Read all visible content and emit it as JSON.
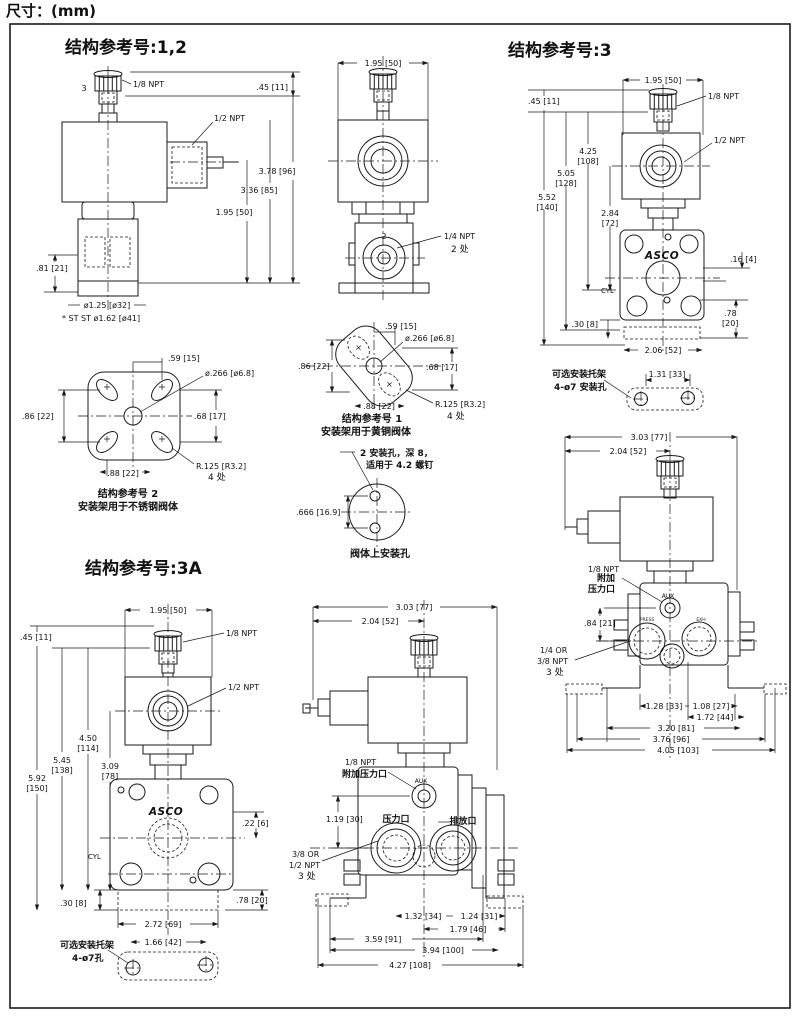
{
  "page": {
    "size_label": "尺寸：(mm)"
  },
  "colors": {
    "ink": "#1a1a1a",
    "paper": "#ffffff"
  },
  "sections": {
    "ref12": {
      "title": "结构参考号:1,2"
    },
    "ref3": {
      "title": "结构参考号:3"
    },
    "ref3a": {
      "title": "结构参考号:3A"
    }
  },
  "valve12_side": {
    "port_num": "3",
    "npt_18": "1/8 NPT",
    "npt_12": "1/2 NPT",
    "dim_top": ".45 [11]",
    "dim_total": "3.78 [96]",
    "dim_mid": "3.36 [85]",
    "dim_coil": "1.95 [50]",
    "dim_body": ".81 [21]",
    "dim_dia": "ø1.25 [ø32]",
    "note": "* ST ST ø1.62 [ø41]"
  },
  "valve12_front": {
    "dim_width": "1.95 [50]",
    "port_num": "2",
    "npt_14": "1/4 NPT",
    "places": "2 处"
  },
  "valve3_front": {
    "dim_width": "1.95 [50]",
    "npt_18": "1/8 NPT",
    "npt_12": "1/2 NPT",
    "dim_top": ".45 [11]",
    "h1a": "4.25",
    "h1b": "[108]",
    "h2a": "5.05",
    "h2b": "[128]",
    "h3a": "5.52",
    "h3b": "[140]",
    "h4a": "2.84",
    "h4b": "[72]",
    "logo": "ASCO",
    "dim_off": ".16 [4]",
    "cyl": "CYL",
    "dim_base": ".30 [8]",
    "dim_lug_a": ".78",
    "dim_lug_b": "[20]",
    "dim_body_w": "2.06 [52]"
  },
  "bracket3_optional": {
    "caption1": "可选安装托架",
    "caption2": "4-ø7 安装孔",
    "dim_holes": "1.31 [33]"
  },
  "plate2": {
    "dim_top": ".59 [15]",
    "dim_hole": "ø.266 [ø6.8]",
    "dim_left": ".86 [22]",
    "dim_right": ".68 [17]",
    "dim_bottom": ".88 [22]",
    "dim_radius": "R.125 [R3.2]",
    "radius_places": "4 处",
    "caption1": "结构参考号 2",
    "caption2": "安装架用于不锈钢阀体"
  },
  "plate1": {
    "dim_top": ".59 [15]",
    "dim_hole": "ø.266 [ø6.8]",
    "dim_left": ".86 [22]",
    "dim_right": ".68 [17]",
    "dim_bottom": ".88 [22]",
    "dim_radius": "R.125 [R3.2]",
    "radius_places": "4 处",
    "caption1": "结构参考号 1",
    "caption2": "安装架用于黄铜阀体"
  },
  "body_holes": {
    "note1": "2 安装孔，深 8，",
    "note2": "适用于 4.2 螺钉",
    "dim_span": ".666 [16.9]",
    "caption": "阀体上安装孔"
  },
  "valve3_side": {
    "dim_total": "3.03 [77]",
    "dim_coil": "2.04 [52]",
    "npt_l1": "1/8 NPT",
    "npt_l2": "附加",
    "npt_l3": "压力口",
    "aux": "AUX",
    "press": "PRESS",
    "exh": "EXH",
    "dim_port": ".84 [21]",
    "port_l1": "1/4 OR",
    "port_l2": "3/8 NPT",
    "port_l3": "3 处",
    "d1": "1.28 [33]",
    "d2": "1.08 [27]",
    "d3": "1.72 [44]",
    "d4": "3.20 [81]",
    "d5": "3.76 [96]",
    "d6": "4.05 [103]"
  },
  "valve3a_front": {
    "dim_width": "1.95 [50]",
    "npt_18": "1/8 NPT",
    "npt_12": "1/2 NPT",
    "dim_top": ".45 [11]",
    "h1a": "4.50",
    "h1b": "[114]",
    "h2a": "5.45",
    "h2b": "[138]",
    "h3a": "5.92",
    "h3b": "[150]",
    "h4a": "3.09",
    "h4b": "[78]",
    "logo": "ASCO",
    "cyl": "CYL",
    "dim_off": ".22 [6]",
    "dim_lug": ".78 [20]",
    "dim_base": ".30 [8]",
    "dim_body_w": "2.72 [69]",
    "bracket_caption1": "可选安装托架",
    "bracket_caption2": "4-ø7孔",
    "bracket_dim": "1.66 [42]"
  },
  "valve3a_side": {
    "dim_total": "3.03 [77]",
    "dim_coil": "2.04 [52]",
    "npt_l1": "1/8 NPT",
    "npt_l2": "附加压力口",
    "aux": "AUX",
    "dim_aux": "1.19 [30]",
    "press_label": "压力口",
    "exh_label": "排放口",
    "port_l1": "3/8 OR",
    "port_l2": "1/2 NPT",
    "port_l3": "3 处",
    "d1": "1.32 [34]",
    "d2": "1.24 [31]",
    "d3": "1.79 [46]",
    "d4": "3.59 [91]",
    "d5": "3.94 [100]",
    "d6": "4.27 [108]"
  }
}
